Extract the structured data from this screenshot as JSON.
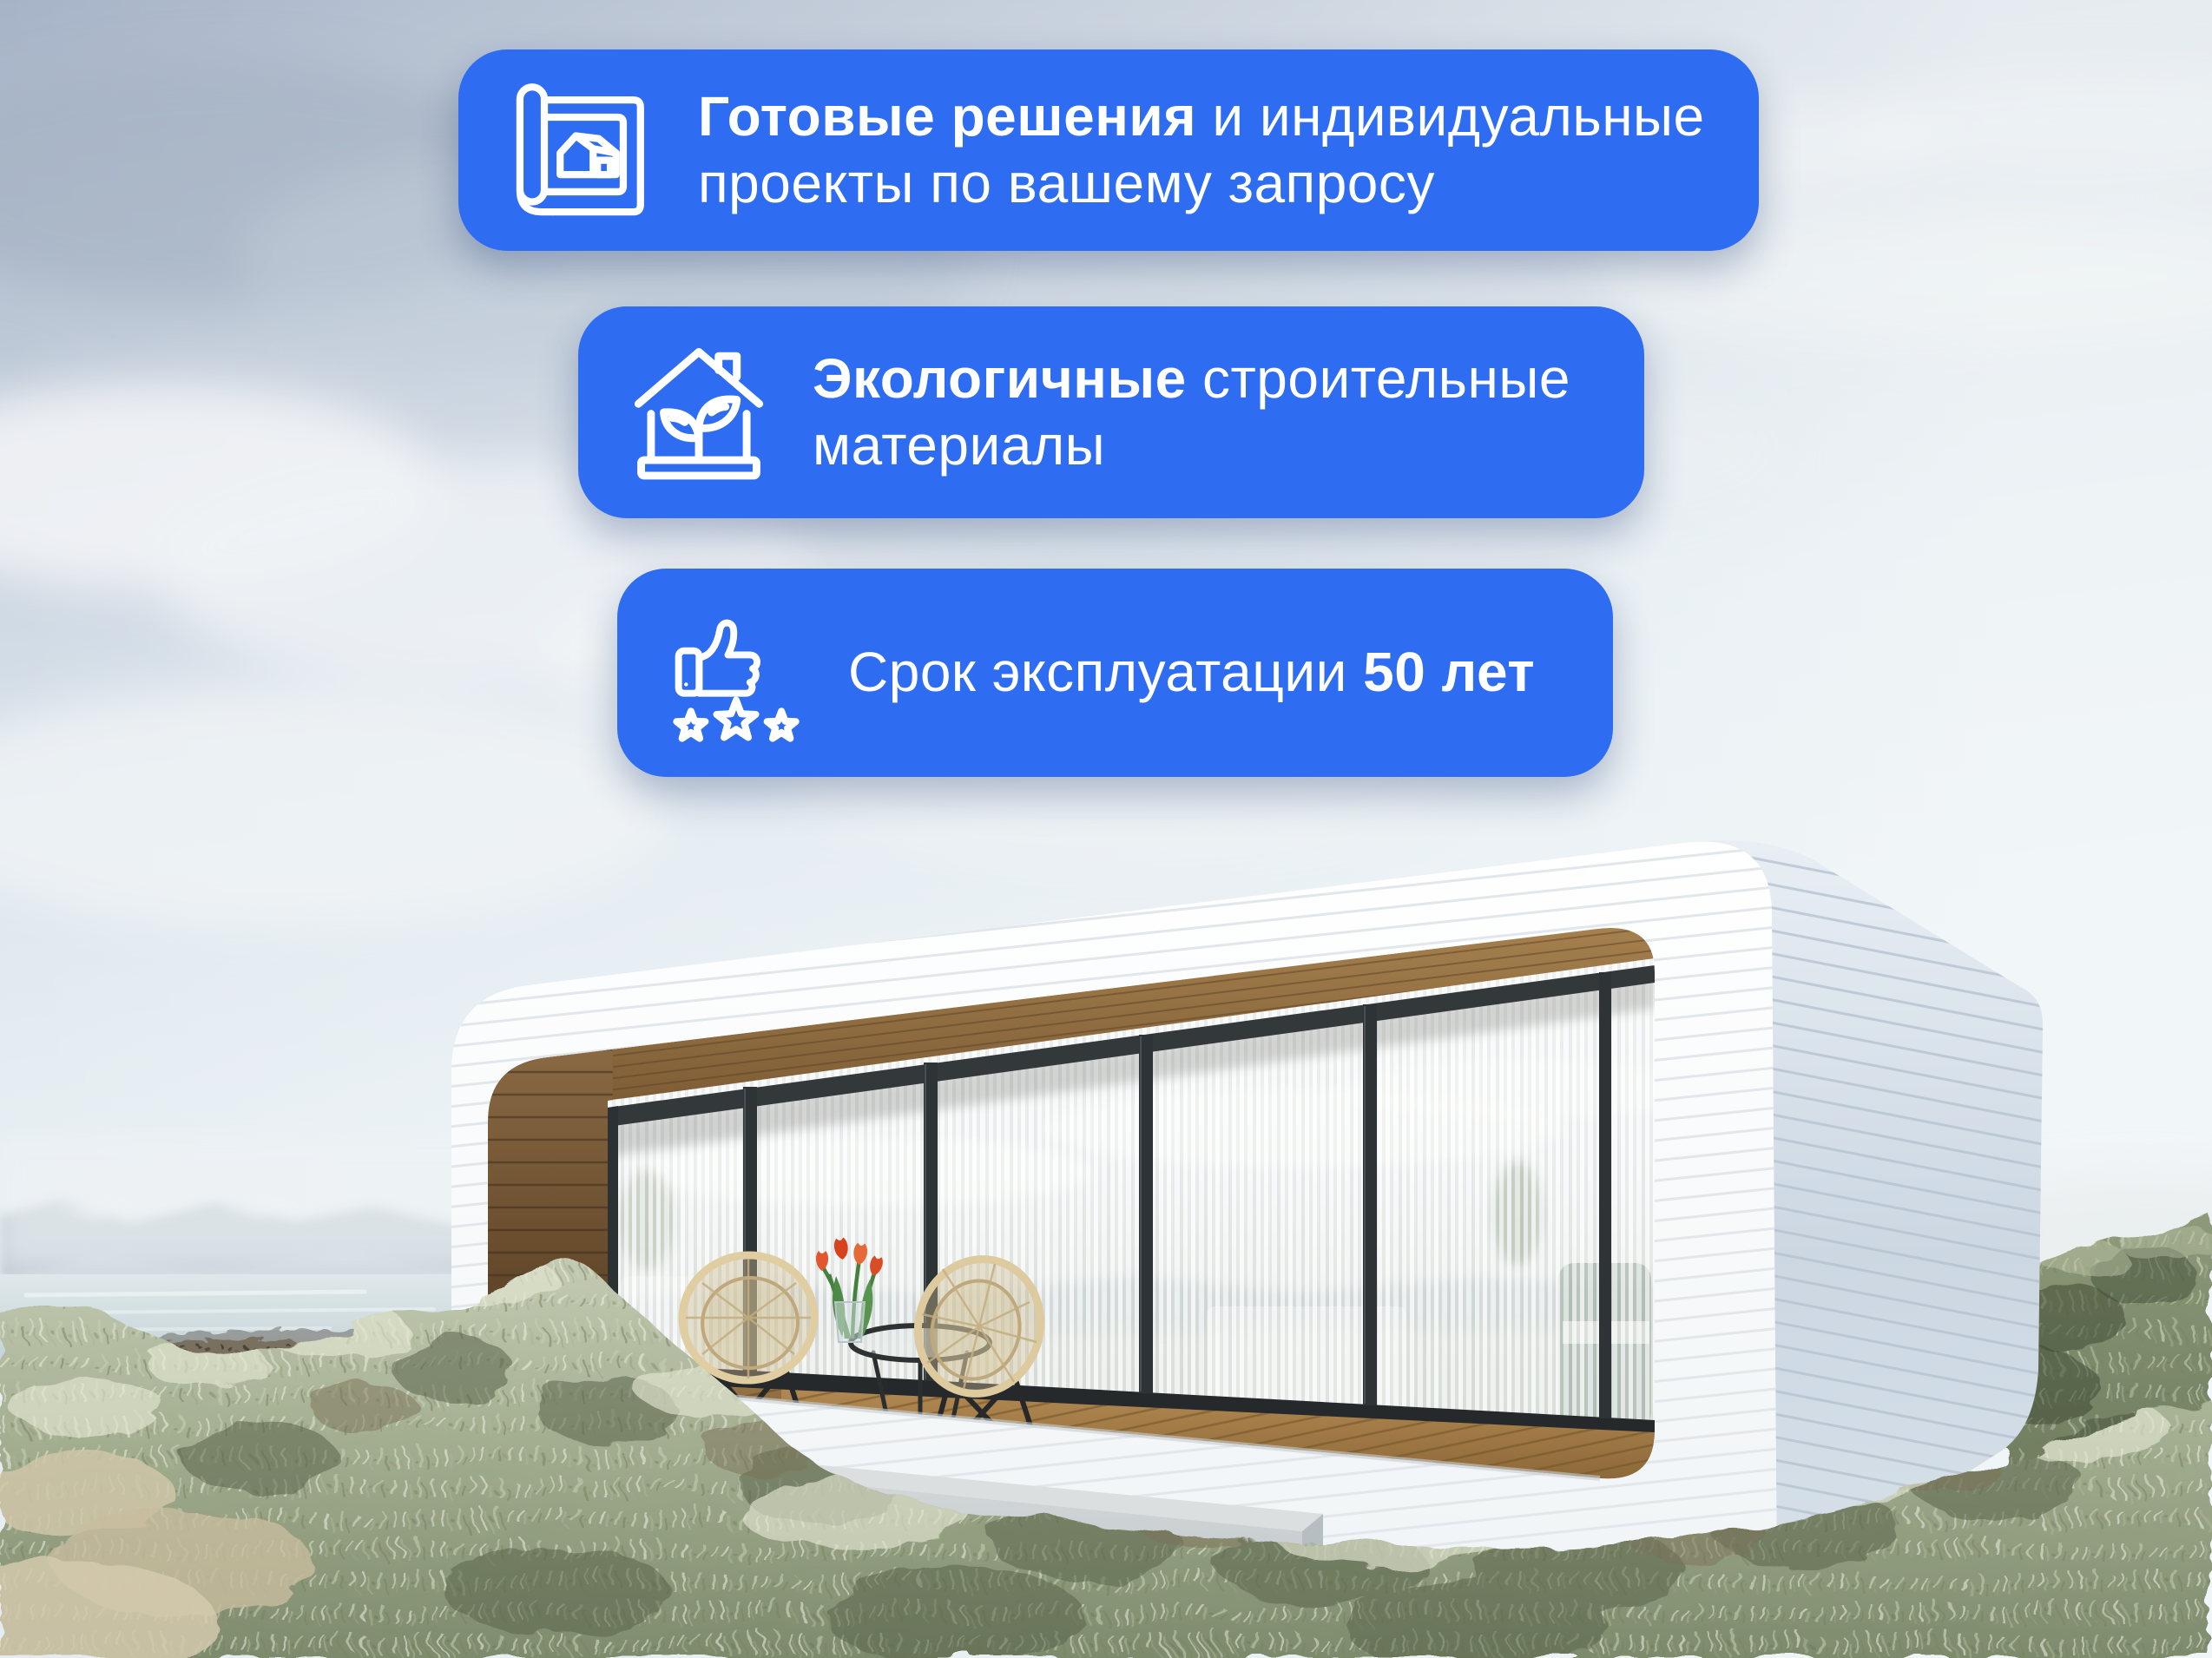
{
  "colors": {
    "card_background": "#2e6cf2",
    "card_text": "#ffffff"
  },
  "cards": [
    {
      "id": "ready-solutions",
      "icon": "blueprint-house-icon",
      "line1_bold": "Готовые решения",
      "line1_regular": " и индивидуальные",
      "line2": "проекты по вашему запросу"
    },
    {
      "id": "eco-materials",
      "icon": "eco-house-sprout-icon",
      "line1_bold": "Экологичные",
      "line1_regular": " строительные",
      "line2": "материалы"
    },
    {
      "id": "lifespan",
      "icon": "thumbs-up-stars-icon",
      "line_regular": "Срок эксплуатации ",
      "line_bold": "50 лет"
    }
  ]
}
